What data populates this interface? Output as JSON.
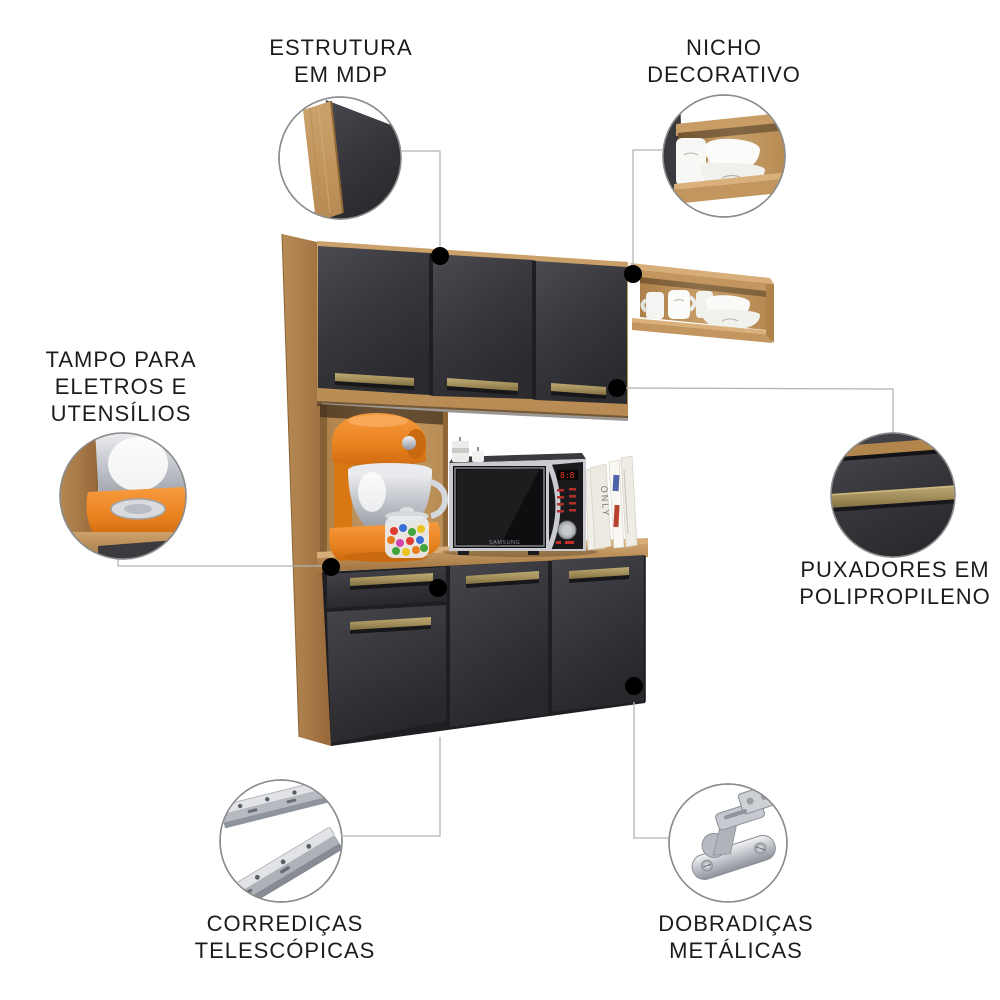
{
  "image_type": "product feature callout diagram",
  "product": "compact kitchen cabinet",
  "background": "#FFFFFF",
  "palette": {
    "wood": "#C79E69",
    "wood_dark": "#A97C49",
    "wood_light": "#D7AE79",
    "door": "#38383D",
    "door_gap": "#1F1F23",
    "handle": "#A3905C",
    "leader_line": "#B3B3B3",
    "dot": "#000000",
    "text": "#1C1C1C",
    "mixer_orange": "#E8821F",
    "metal": "#C9CBD0"
  },
  "callouts": {
    "estrutura": {
      "lines": [
        "ESTRUTURA",
        "EM MDP"
      ]
    },
    "nicho": {
      "lines": [
        "NICHO",
        "DECORATIVO"
      ]
    },
    "tampo": {
      "lines": [
        "TAMPO PARA",
        "ELETROS E",
        "UTENSÍLIOS"
      ]
    },
    "puxadores": {
      "lines": [
        "PUXADORES EM",
        "POLIPROPILENO"
      ]
    },
    "corredicas": {
      "lines": [
        "CORREDIÇAS",
        "TELESCÓPICAS"
      ]
    },
    "dobradicas": {
      "lines": [
        "DOBRADIÇAS",
        "METÁLICAS"
      ]
    }
  },
  "scene": {
    "microwave_brand": "SAMSUNG",
    "book_spine_text": "ONLY"
  }
}
